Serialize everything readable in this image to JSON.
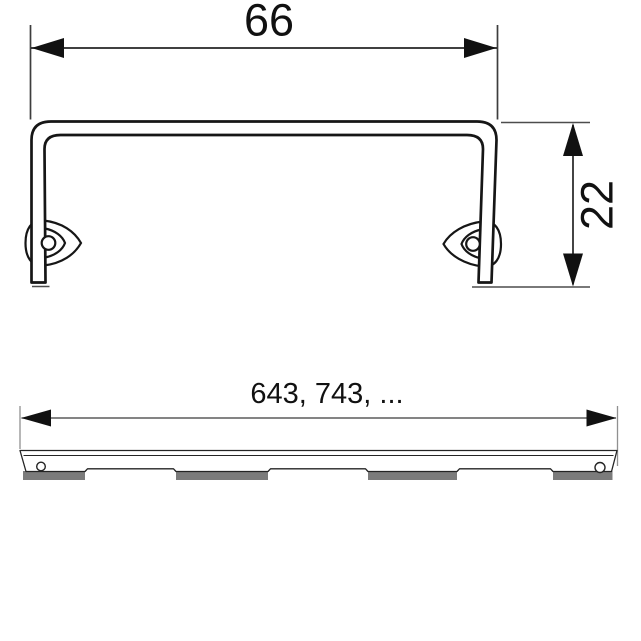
{
  "colors": {
    "background": "#ffffff",
    "line": "#1a1a1a",
    "foot_shade": "#7b7b7b"
  },
  "views": {
    "cross_section": {
      "width_mm": "66",
      "height_mm": "22"
    },
    "side_profile": {
      "length_mm": "643, 743, ..."
    }
  }
}
